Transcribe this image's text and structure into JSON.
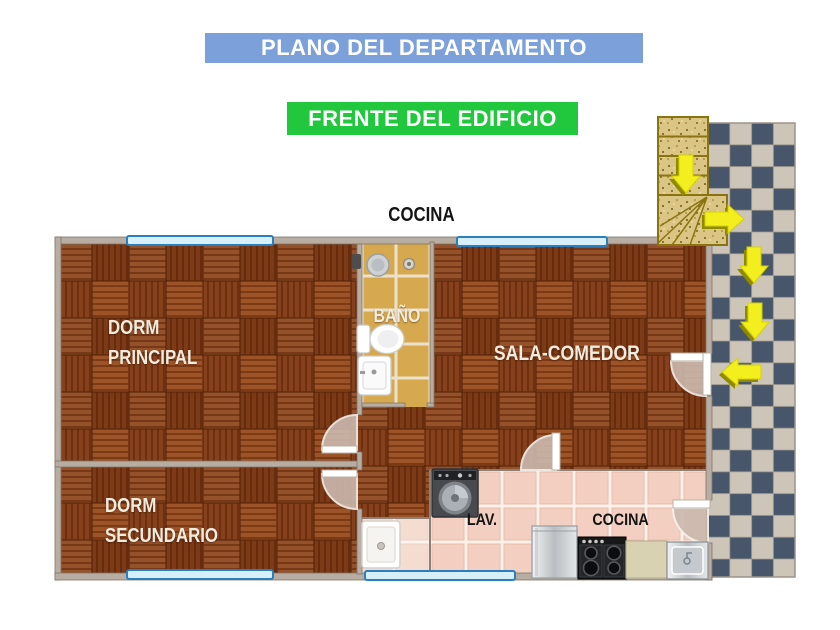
{
  "banners": {
    "title": {
      "label": "PLANO DEL DEPARTAMENTO",
      "bg": "#7ca1da",
      "fg": "#ffffff"
    },
    "subtitle": {
      "label": "FRENTE DEL EDIFICIO",
      "bg": "#21c73c",
      "fg": "#ffffff"
    }
  },
  "labels": {
    "top_kitchen": "COCINA",
    "dorm_principal_line1": "DORM",
    "dorm_principal_line2": "PRINCIPAL",
    "dorm_secundario_line1": "DORM",
    "dorm_secundario_line2": "SECUNDARIO",
    "bathroom": "BAÑO",
    "living_dining": "SALA-COMEDOR",
    "laundry": "LAV.",
    "kitchen": "COCINA"
  },
  "colors": {
    "banner_blue": "#7ca1da",
    "banner_green": "#21c73c",
    "parquet_dark": "#7d3a16",
    "parquet_light": "#94512a",
    "bath_tile": "#d6a94e",
    "kitchen_tile": "#f2cfc0",
    "checker_dark": "#47566a",
    "checker_light": "#cdc5b8",
    "stairs_sand": "#dbc584",
    "arrow_yellow": "#f3ef1e",
    "window_fill": "#d6eff9",
    "window_border": "#2a7fc0",
    "wall": "#b7ada2",
    "room_label_text": "#f2ecdf",
    "kitchen_label_text": "#141414"
  },
  "plan": {
    "rooms": [
      "DORM PRINCIPAL",
      "DORM SECUNDARIO",
      "BAÑO",
      "SALA-COMEDOR",
      "LAV.",
      "COCINA"
    ],
    "fixtures": [
      "shower drain",
      "floor drain",
      "shower control",
      "toilet",
      "bathroom sink",
      "washing machine",
      "laundry sink",
      "refrigerator",
      "stove",
      "counter",
      "kitchen sink"
    ],
    "stairs_arrows": [
      "down",
      "right",
      "down",
      "down",
      "left"
    ],
    "windows_count": 4,
    "doors_count": 5
  }
}
